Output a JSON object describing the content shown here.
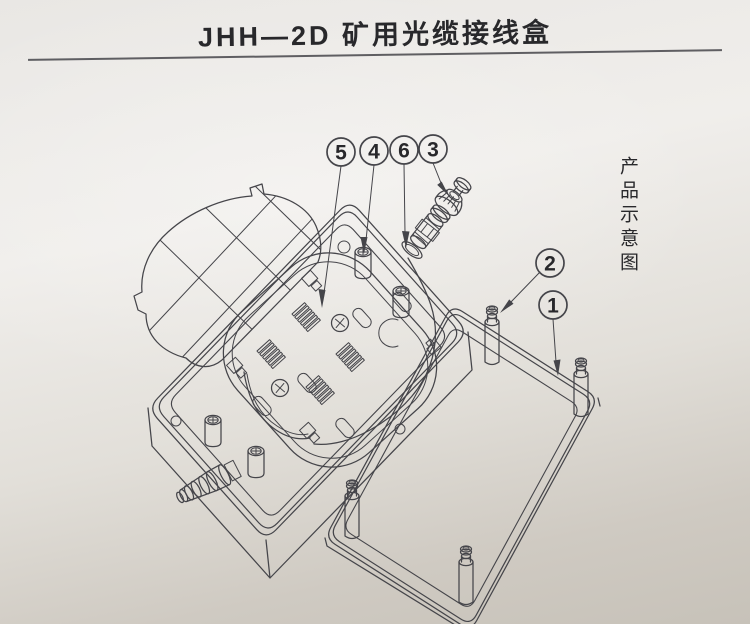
{
  "page": {
    "title": "JHH—2D 矿用光缆接线盒",
    "side_label": "产品示意图"
  },
  "callouts": {
    "c1": "1",
    "c2": "2",
    "c3": "3",
    "c4": "4",
    "c5": "5",
    "c6": "6"
  },
  "colors": {
    "paper_light": "#f0eeeb",
    "paper_dark": "#c7c2b9",
    "line": "#45454a",
    "text": "#28282b"
  }
}
